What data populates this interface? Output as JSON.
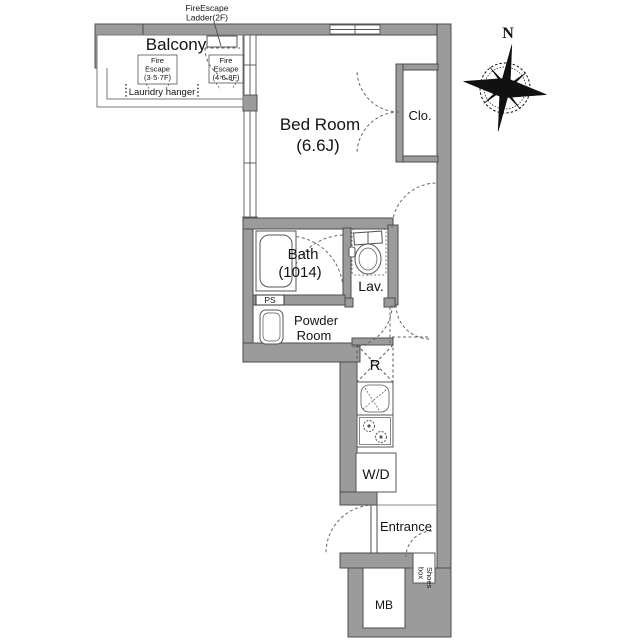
{
  "plan": {
    "type": "apartment-floor-plan",
    "rooms": {
      "balcony": "Balcony",
      "bedroom": "Bed Room",
      "bedroom_size": "(6.6J)",
      "closet": "Clo.",
      "bath": "Bath",
      "bath_size": "(1014)",
      "lavatory": "Lav.",
      "pipe_shaft": "PS",
      "powder_line1": "Powder",
      "powder_line2": "Room",
      "refrigerator": "R",
      "washer_dryer": "W/D",
      "entrance": "Entrance",
      "shoes_line1": "Shoes",
      "shoes_line2": "box",
      "meter_box": "MB"
    },
    "annotations": {
      "ladder_line1": "FireEscape",
      "ladder_line2": "Ladder(2F)",
      "fire_escape1_line1": "Fire",
      "fire_escape1_line2": "Escape",
      "fire_escape1_line3": "(3·5·7F)",
      "fire_escape2_line1": "Fire",
      "fire_escape2_line2": "Escape",
      "fire_escape2_line3": "(4·6·8F)",
      "laundry_hanger": "Laundry hanger",
      "compass_north": "N"
    },
    "colors": {
      "wall_fill": "#9b9b9b",
      "wall_stroke": "#4d4d4d",
      "line": "#555555",
      "text": "#141414",
      "background": "#ffffff"
    }
  }
}
